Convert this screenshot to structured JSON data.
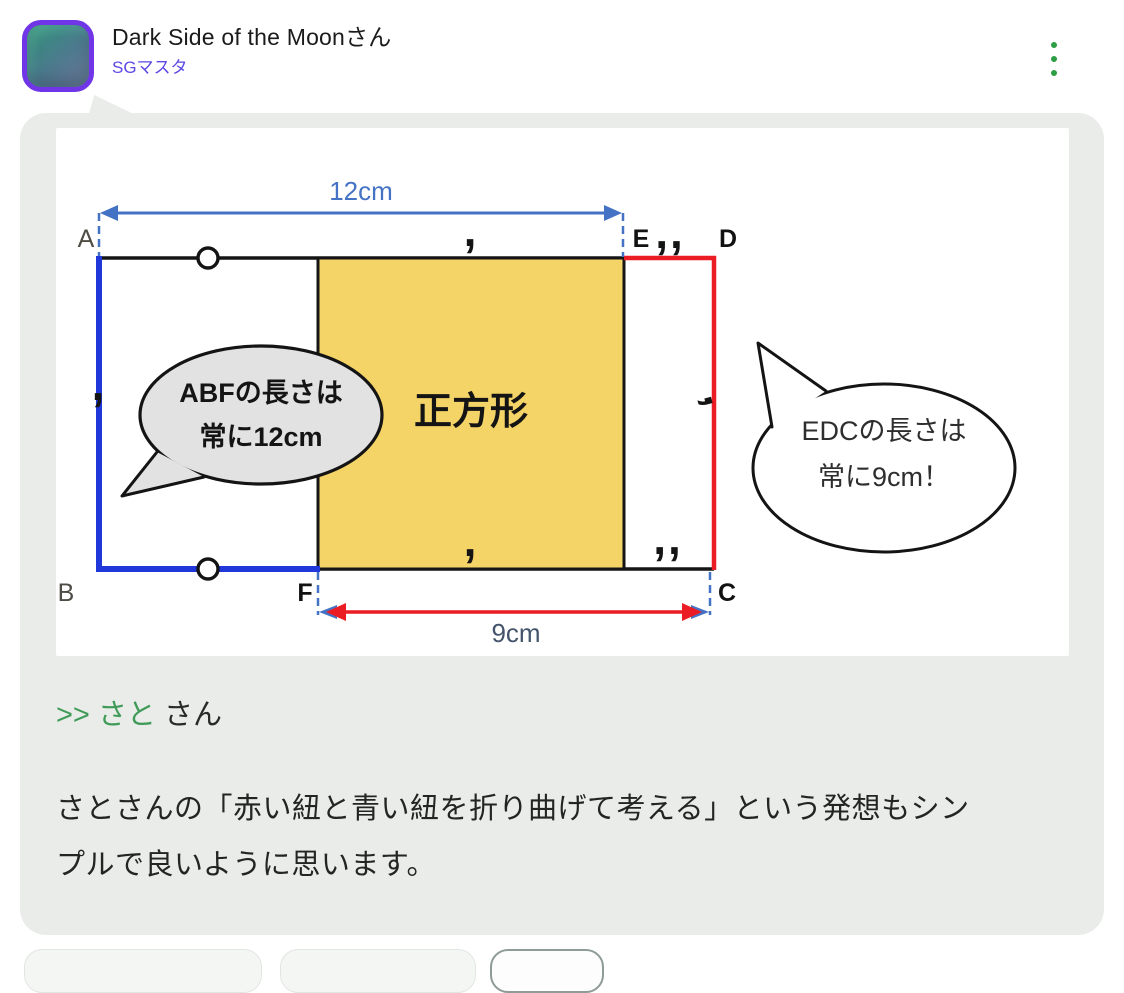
{
  "header": {
    "username": "Dark Side of the Moonさん",
    "badge": "SGマスタ"
  },
  "post": {
    "reply_link": ">> さと",
    "reply_suffix": "さん",
    "body_line1": "さとさんの「赤い紐と青い紐を折り曲げて考える」という発想もシン",
    "body_line2": "プルで良いように思います。"
  },
  "diagram": {
    "dim_top": "12cm",
    "dim_bottom": "9cm",
    "square_label": "正方形",
    "points": {
      "A": "A",
      "B": "B",
      "C": "C",
      "D": "D",
      "E": "E",
      "F": "F"
    },
    "bubble_left": {
      "line1": "ABFの長さは",
      "line2": "常に12cm"
    },
    "bubble_right": {
      "line1": "EDCの長さは",
      "line2": "常に9cm！"
    },
    "marks": {
      "single": ",",
      "double": ",,"
    }
  },
  "colors": {
    "card_bg": "#e9ece9",
    "accent_green": "#2e9e44",
    "reply_green": "#3f9b57",
    "badge_purple": "#5b49e6",
    "avatar_ring": "#6f35e6",
    "rope_blue": "#2038d9",
    "rope_red": "#ec1c24",
    "dimension_blue": "#4472c4",
    "dimension_text_dark": "#44546a",
    "square_yellow": "#f4d367",
    "bubble_gray": "#e2e2e2"
  }
}
